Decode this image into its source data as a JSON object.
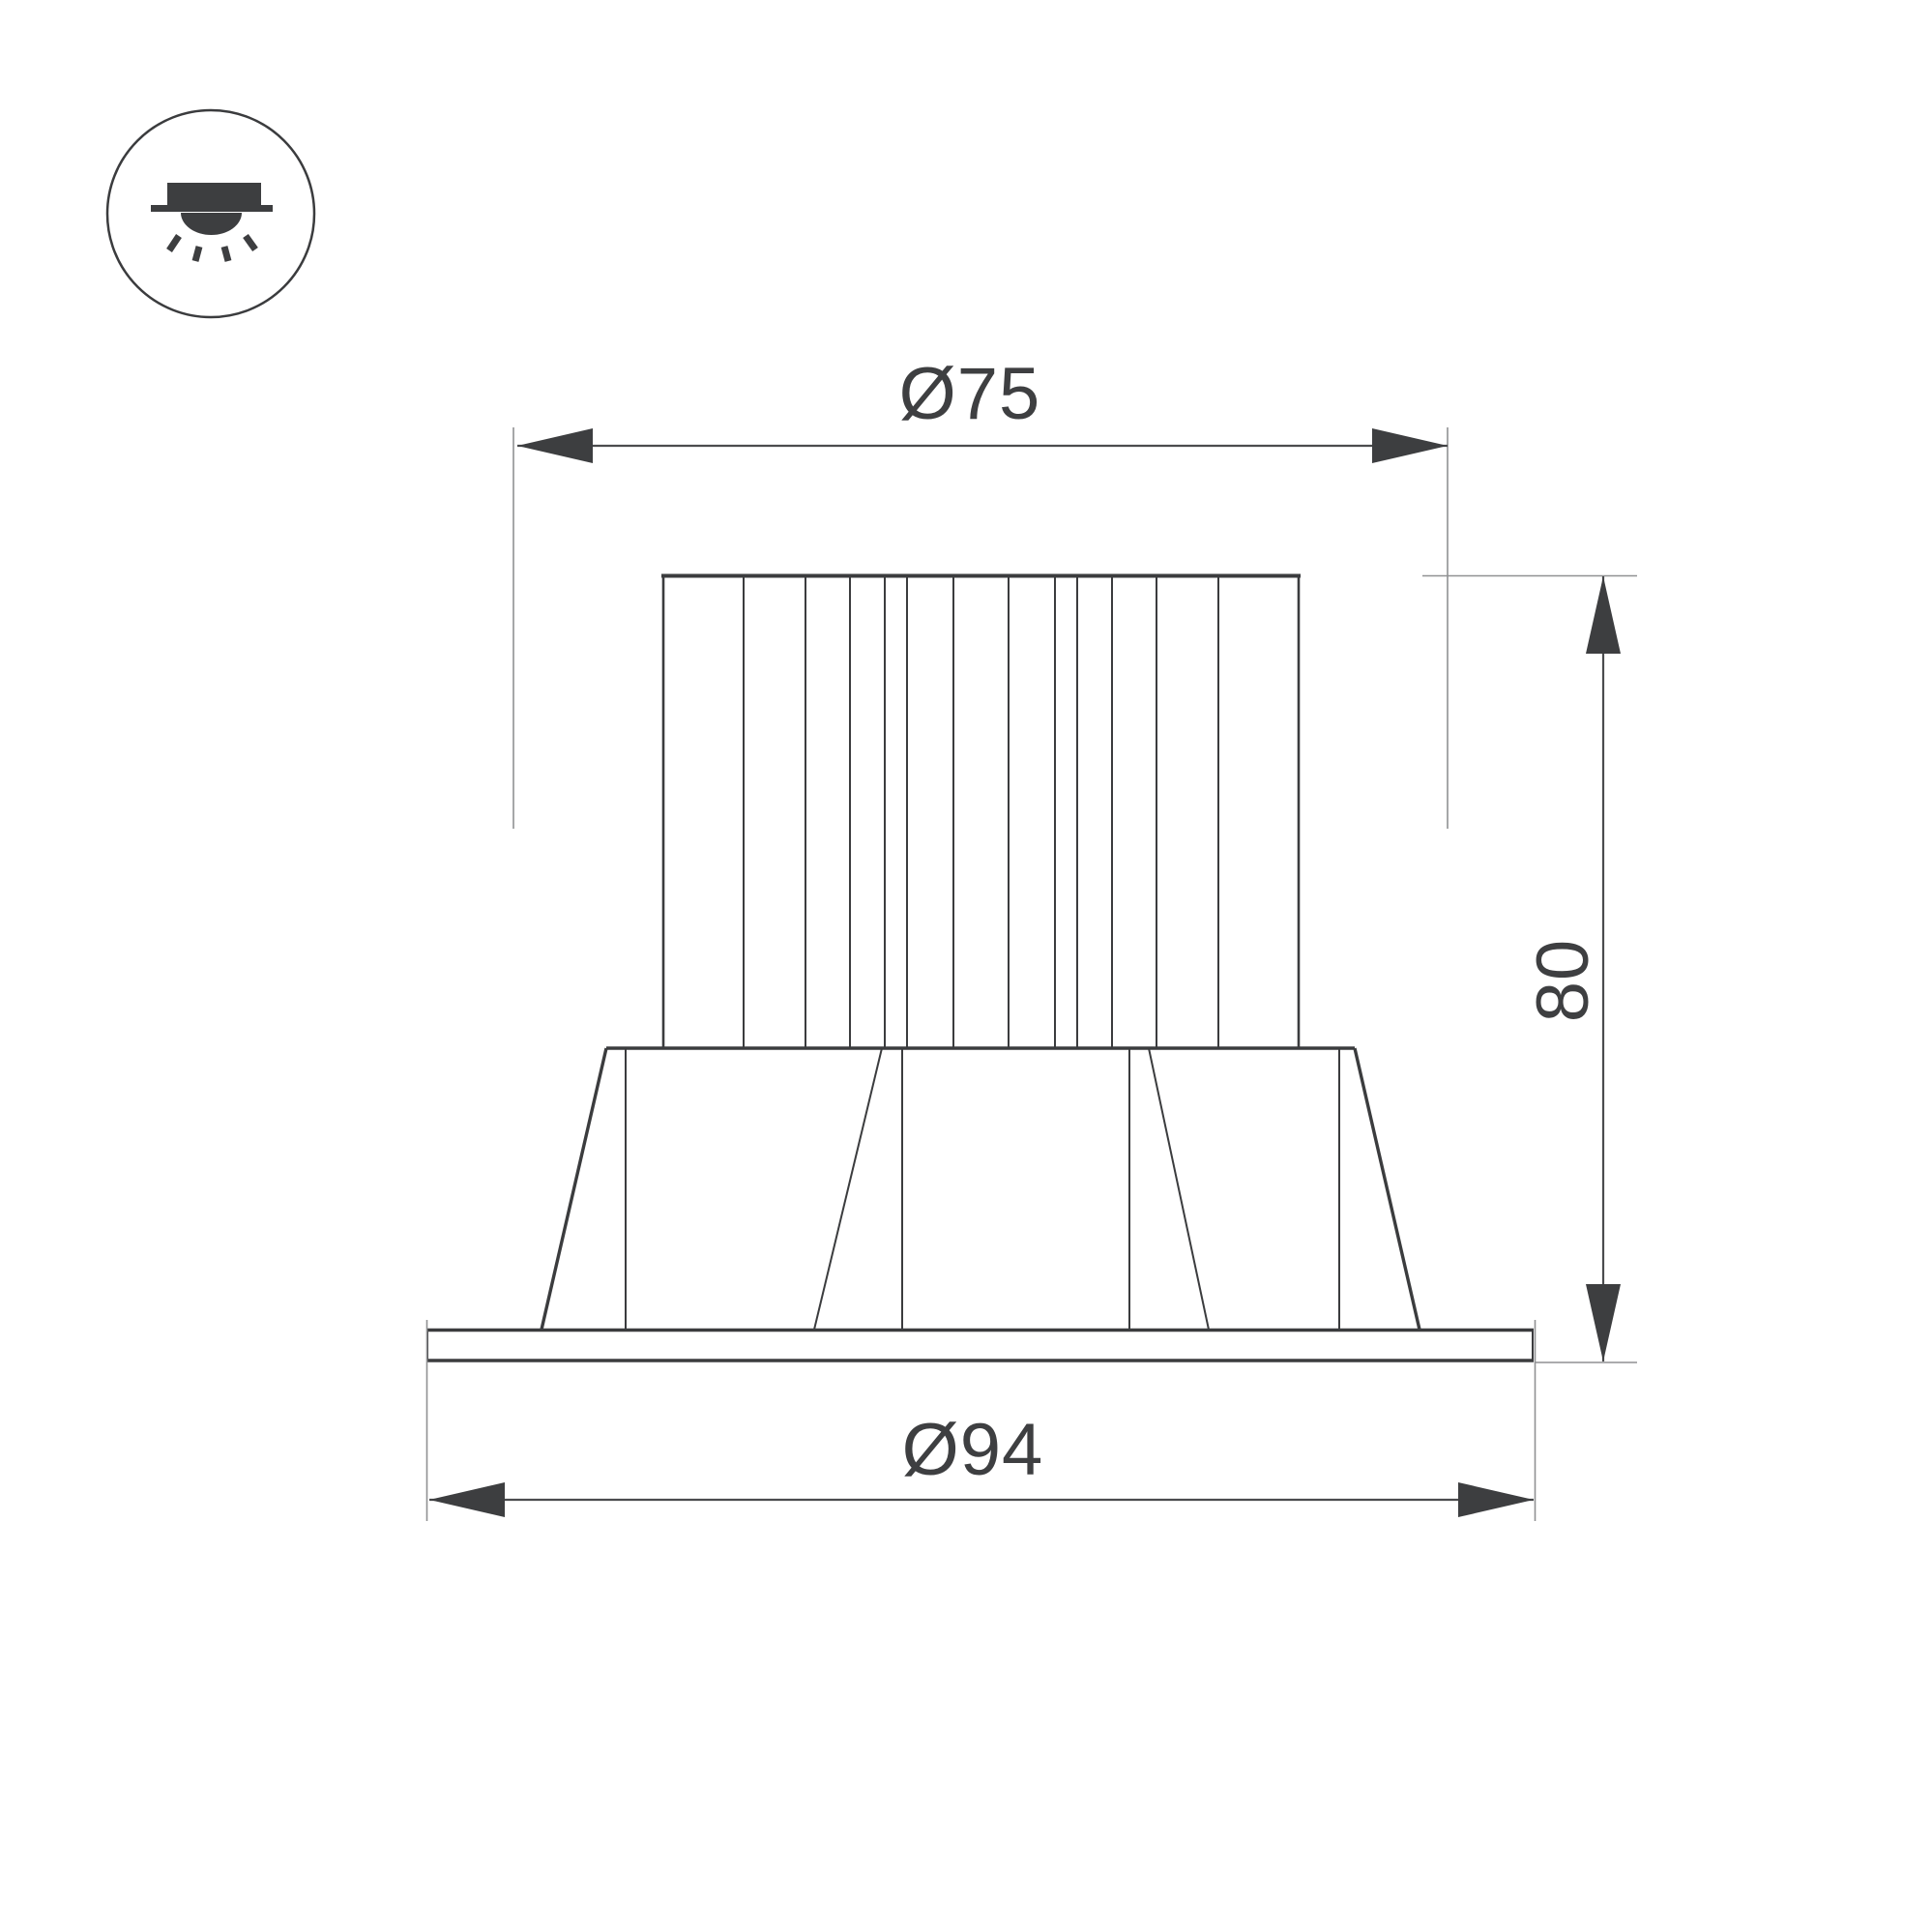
{
  "drawing": {
    "type": "technical-dimension-drawing",
    "subject": "recessed-downlight-side-view"
  },
  "icon_badge": {
    "name": "recessed-downlight-icon"
  },
  "dimensions": {
    "top_diameter": {
      "label": "Ø75",
      "value": 75
    },
    "height": {
      "label": "80",
      "value": 80
    },
    "bottom_diameter": {
      "label": "Ø94",
      "value": 94
    }
  },
  "colors": {
    "background": "#ffffff",
    "outline": "#3b3c3e",
    "dimension_line": "#4b4c4e",
    "extension_line": "#909193",
    "dark_fill": "#3d3e40",
    "text": "#3e3f41"
  }
}
